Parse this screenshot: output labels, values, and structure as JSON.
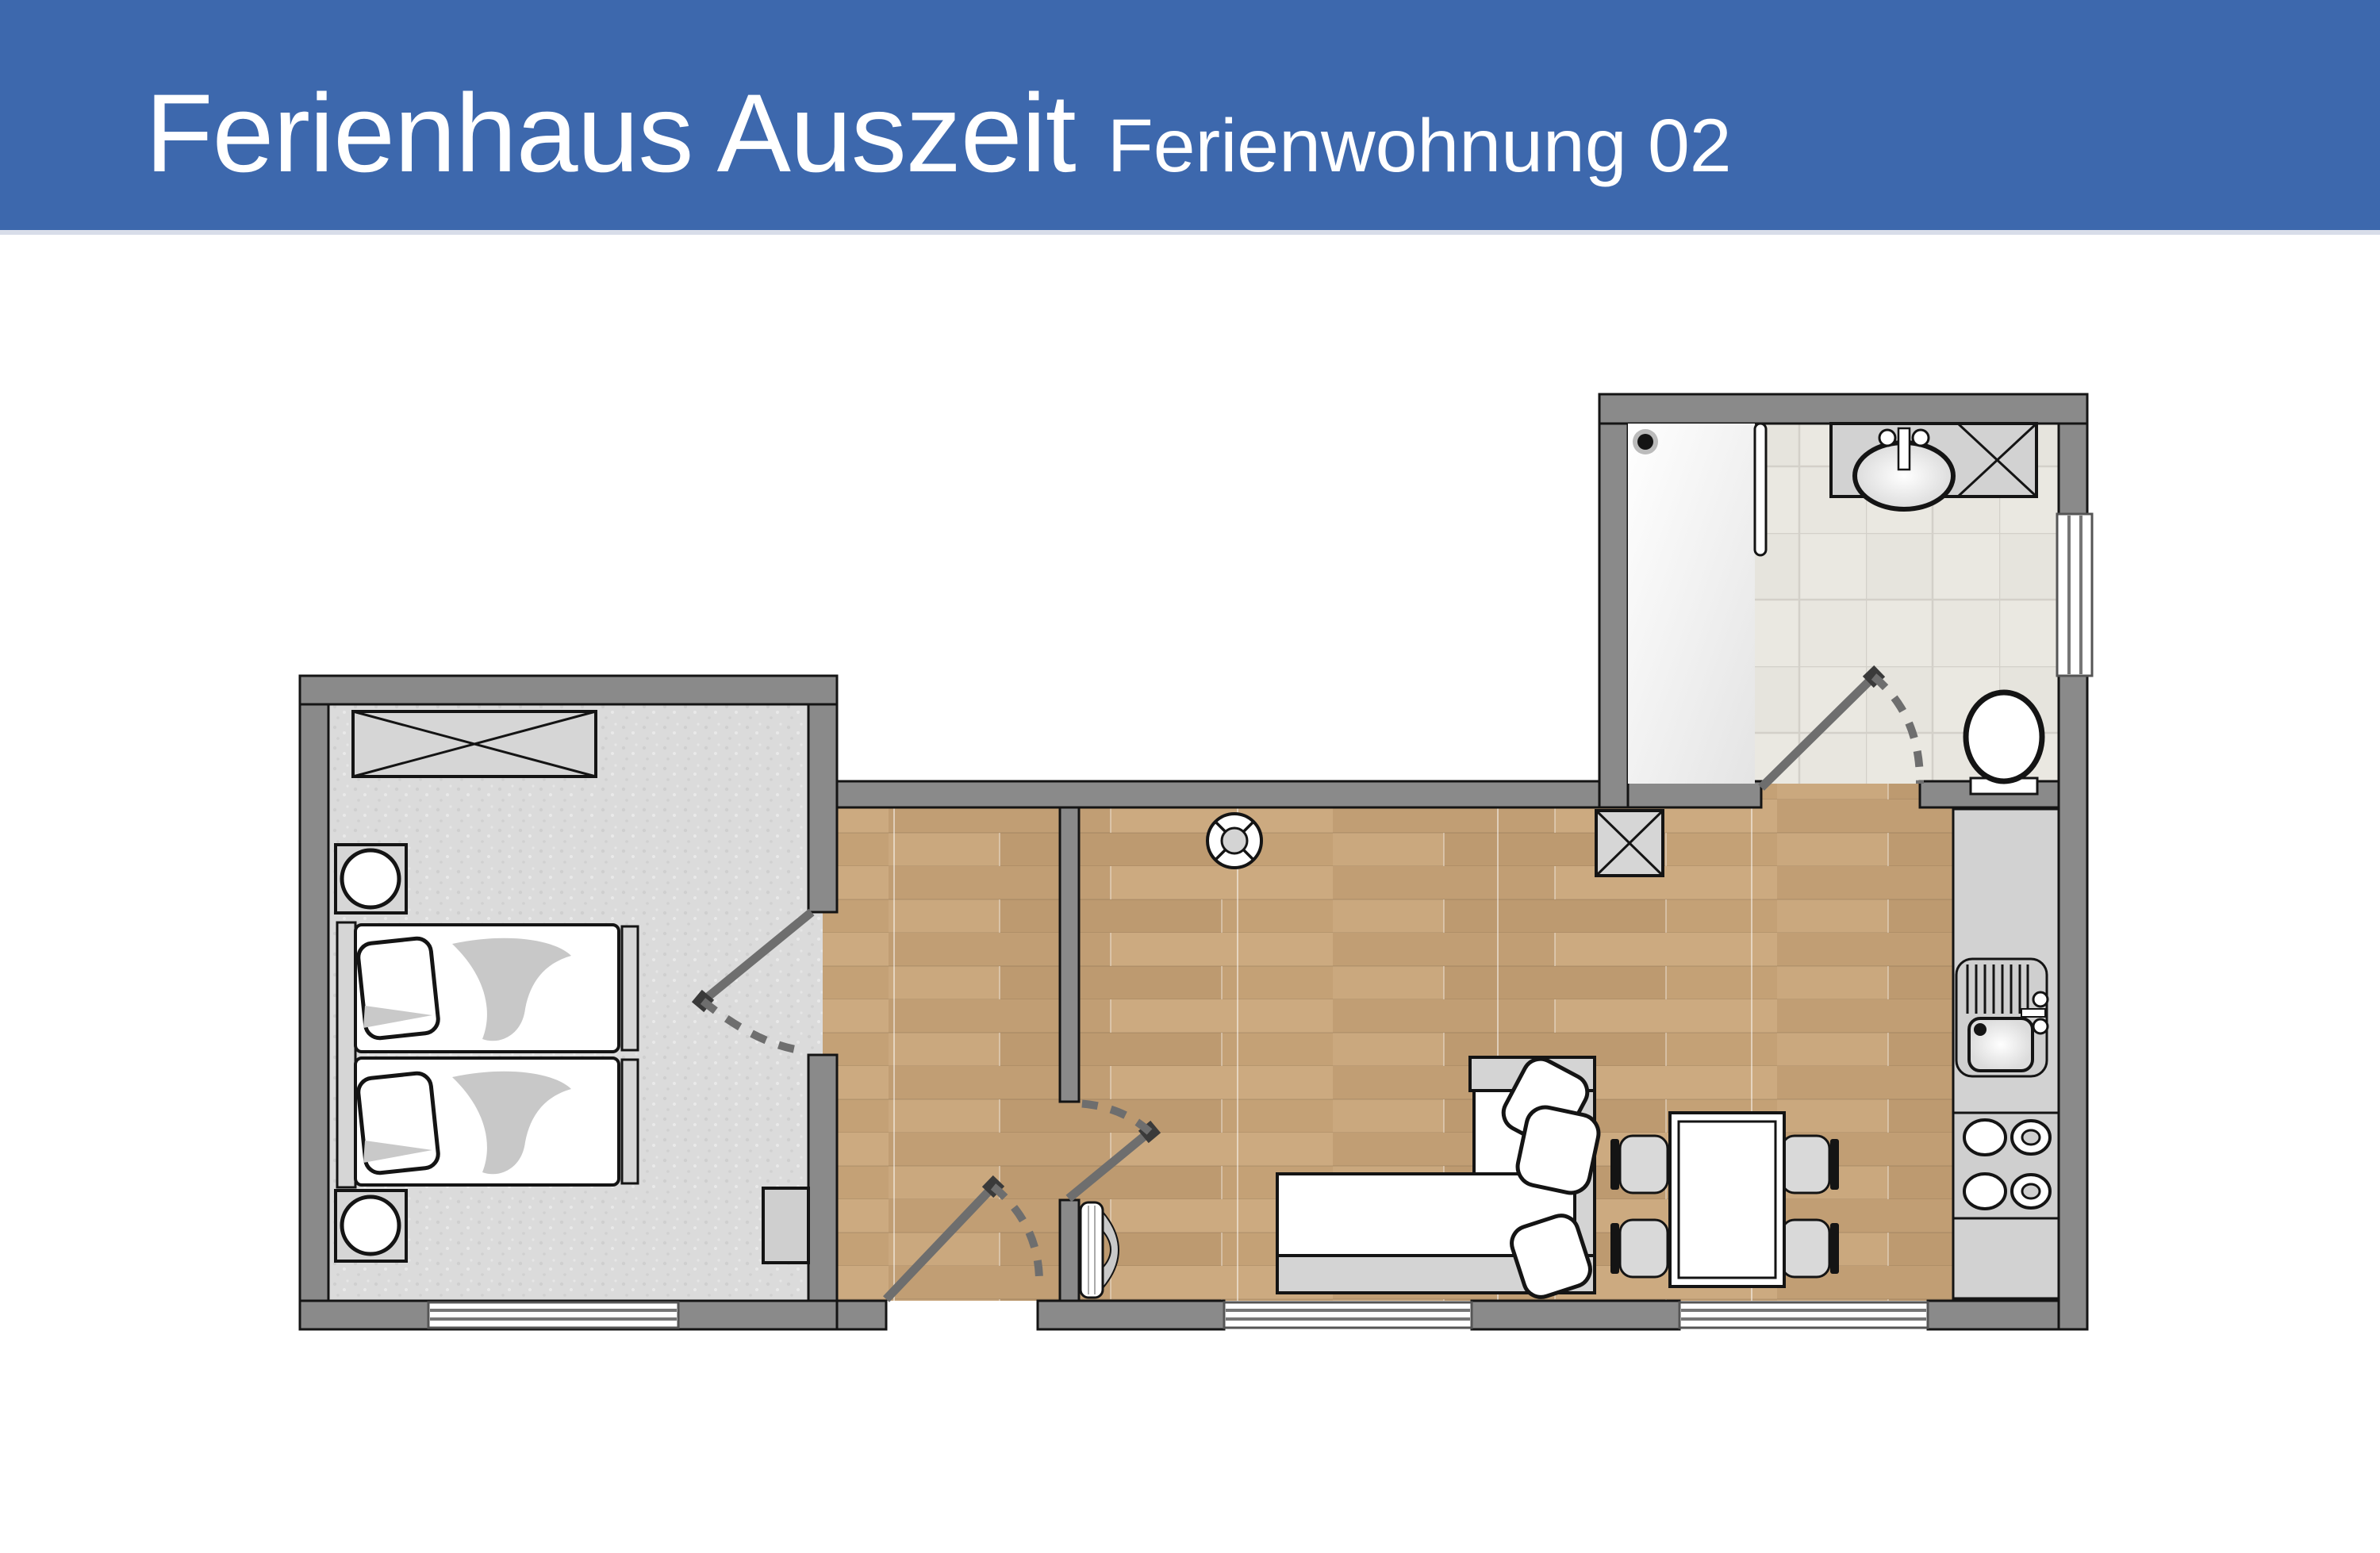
{
  "header": {
    "title": "Ferienhaus Auszeit",
    "subtitle": "Ferienwohnung 02"
  },
  "colors": {
    "accent": "#3D68AD",
    "header_text": "#FFFFFF",
    "wall": "#8A8A8A",
    "outline": "#141414",
    "wood_floor": "#C7A57C",
    "carpet_floor": "#DBDBDB",
    "tile_floor": "#EAE8E1",
    "furniture_gray": "#D5D5D5",
    "counter": "#CFCFCF",
    "door_swing": "#6E6E6E",
    "window_frame": "#555555"
  }
}
